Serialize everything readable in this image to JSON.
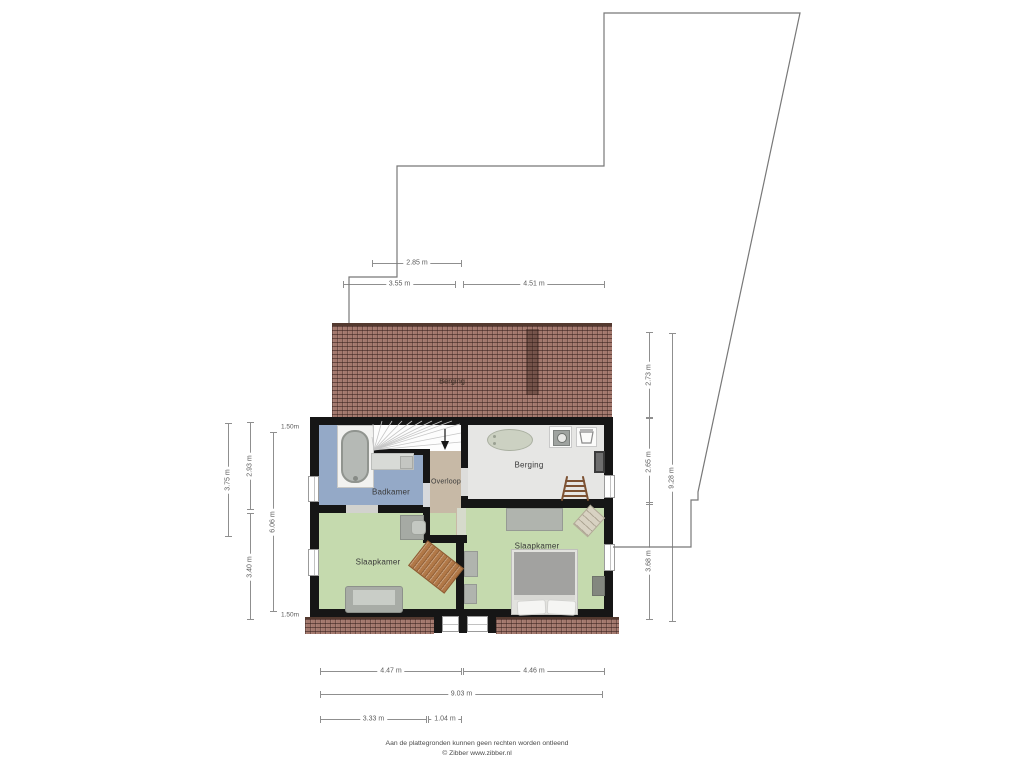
{
  "plan": {
    "attic_label": "Berging",
    "rooms": {
      "bathroom": "Badkamer",
      "landing": "Overloop",
      "storage": "Berging",
      "bedroom_left": "Slaapkamer",
      "bedroom_right": "Slaapkamer"
    }
  },
  "dimensions": {
    "top": [
      {
        "label": "2.85 m"
      },
      {
        "label": "3.55 m"
      },
      {
        "label": "4.51 m"
      }
    ],
    "left": [
      {
        "label": "3.75 m"
      },
      {
        "label": "2.93 m"
      },
      {
        "label": "3.40 m"
      },
      {
        "label": "6.06 m"
      }
    ],
    "height_marks": [
      {
        "label": "1.50m"
      },
      {
        "label": "1.50m"
      }
    ],
    "right": [
      {
        "label": "2.73 m"
      },
      {
        "label": "2.65 m"
      },
      {
        "label": "3.68 m"
      },
      {
        "label": "9.28 m"
      }
    ],
    "bottom": [
      {
        "label": "4.47 m"
      },
      {
        "label": "4.46 m"
      },
      {
        "label": "9.03 m"
      },
      {
        "label": "3.33 m"
      },
      {
        "label": "1.04 m"
      }
    ]
  },
  "footer": {
    "disclaimer": "Aan de plattegronden kunnen geen rechten worden ontleend",
    "copyright": "© Zibber www.zibber.nl"
  },
  "colors": {
    "bathroom_floor": "#94a9c7",
    "landing_floor": "#c7b9a6",
    "storage_floor": "#e6e6e4",
    "bedroom_floor": "#c5daae",
    "roof_tile": "#a3786d",
    "roof_ridge": "#53392f",
    "wall": "#161616",
    "dimension_line": "#8f8f8f",
    "rug_wood": "#b17847"
  }
}
